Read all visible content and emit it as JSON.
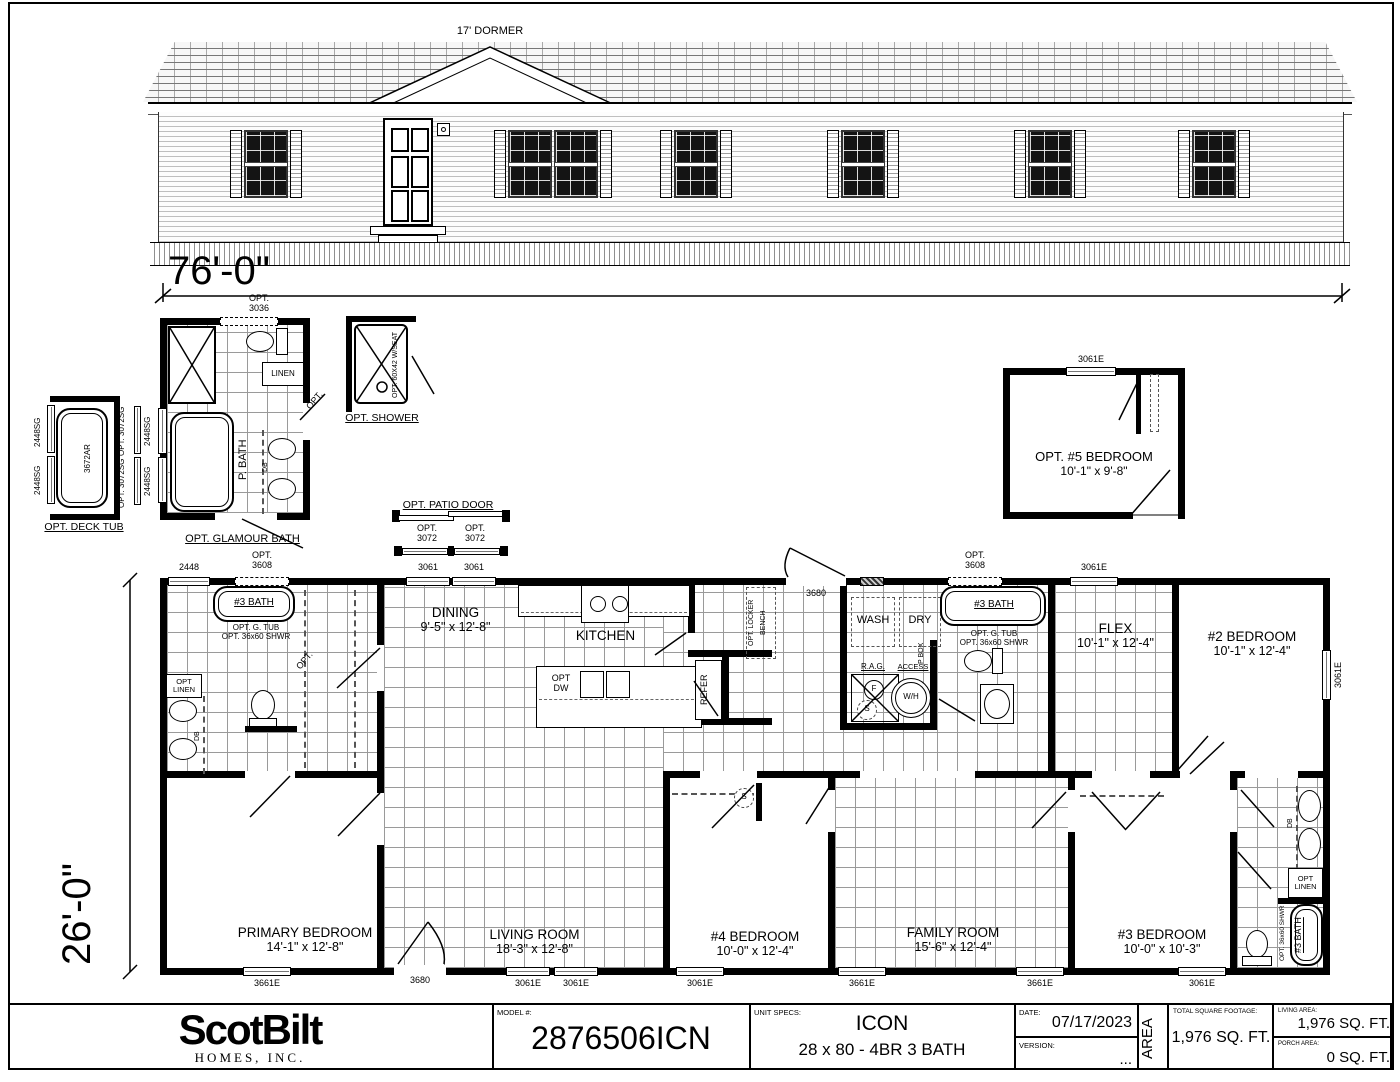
{
  "sheet": {
    "dormer_label": "17' DORMER",
    "width_dim": "76'-0\"",
    "depth_dim": "26'-0\""
  },
  "options": {
    "deck_tub": {
      "label": "OPT. DECK TUB",
      "model": "3672AR",
      "win_far_1": "2448SG",
      "win_far_2": "2448SG",
      "win_mid_1": "OPT. 3072SG",
      "win_mid_2": "OPT. 3072SG",
      "win_near_1": "2448SG",
      "win_near_2": "2448SG"
    },
    "glamour": {
      "label": "OPT. GLAMOUR BATH",
      "window": "OPT. 3036",
      "linen": "LINEN",
      "room": "P. BATH",
      "db": "DB",
      "door": "OPT."
    },
    "shower": {
      "label": "OPT. SHOWER",
      "note": "OPT. 60X42 W/SEAT"
    },
    "patio": {
      "label": "OPT. PATIO DOOR",
      "win1": "OPT. 3072",
      "win2": "OPT. 3072"
    },
    "bed5": {
      "name": "OPT. #5 BEDROOM",
      "dims": "10'-1\" x 9'-8\"",
      "window": "3061E"
    }
  },
  "rooms": {
    "primary": {
      "name": "PRIMARY BEDROOM",
      "dims": "14'-1\" x 12'-8\""
    },
    "living": {
      "name": "LIVING ROOM",
      "dims": "18'-3\" x 12'-8\""
    },
    "dining": {
      "name": "DINING",
      "dims": "9'-5\" x 12'-8\""
    },
    "kitchen": {
      "name": "KITCHEN"
    },
    "bed4": {
      "name": "#4 BEDROOM",
      "dims": "10'-0\" x 12'-4\""
    },
    "family": {
      "name": "FAMILY ROOM",
      "dims": "15'-6\" x 12'-4\""
    },
    "bed3": {
      "name": "#3 BEDROOM",
      "dims": "10'-0\" x 10'-3\""
    },
    "bed2": {
      "name": "#2 BEDROOM",
      "dims": "10'-1\" x 12'-4\""
    },
    "flex": {
      "name": "FLEX",
      "dims": "10'-1\" x 12'-4\""
    }
  },
  "plan": {
    "bath_left": {
      "name": "#3 BATH",
      "opt": "OPT. G. TUB",
      "opt2": "OPT. 36x60 SHWR",
      "linen": "OPT LINEN",
      "db": "DB",
      "door": "OPT."
    },
    "bath_mid": {
      "name": "#3 BATH",
      "opt": "OPT. G. TUB",
      "opt2": "OPT. 36x60 SHWR"
    },
    "bath_right": {
      "name": "#3 BATH",
      "shwr": "OPT. 36x60 SHWR",
      "linen": "OPT LINEN",
      "db": "DB"
    },
    "utility": {
      "wash": "WASH",
      "dry": "DRY",
      "pbox": "P BOX",
      "rag": "R.A.G.",
      "f": "F",
      "s": "S",
      "access": "ACCESS",
      "wh": "W/H"
    },
    "kitchen": {
      "dw1": "OPT",
      "dw2": "DW",
      "refer": "REFER",
      "locker": "OPT. LOCKER",
      "bench": "BENCH"
    },
    "closet_s": "S",
    "door_top": "3680"
  },
  "windows": {
    "top": [
      "2448",
      "OPT. 3608",
      "3061",
      "3061",
      "3680",
      "OPT. 3608",
      "3061E"
    ],
    "bottom": [
      "3661E",
      "3680",
      "3061E",
      "3061E",
      "3061E",
      "3661E",
      "3661E",
      "3061E"
    ],
    "right_side": "3061E"
  },
  "title_block": {
    "brand": "ScotBilt",
    "brand_sub": "HOMES, INC.",
    "model_label": "MODEL #:",
    "model": "2876506ICN",
    "specs_label": "UNIT SPECS:",
    "specs_line1": "ICON",
    "specs_line2": "28 x 80 - 4BR 3 BATH",
    "date_label": "DATE:",
    "date": "07/17/2023",
    "version_label": "VERSION:",
    "version": "...",
    "area_label": "AREA",
    "total_label": "TOTAL SQUARE FOOTAGE:",
    "total": "1,976 SQ. FT.",
    "living_label": "LIVING AREA:",
    "living": "1,976 SQ. FT.",
    "porch_label": "PORCH AREA:",
    "porch": "0 SQ. FT."
  }
}
